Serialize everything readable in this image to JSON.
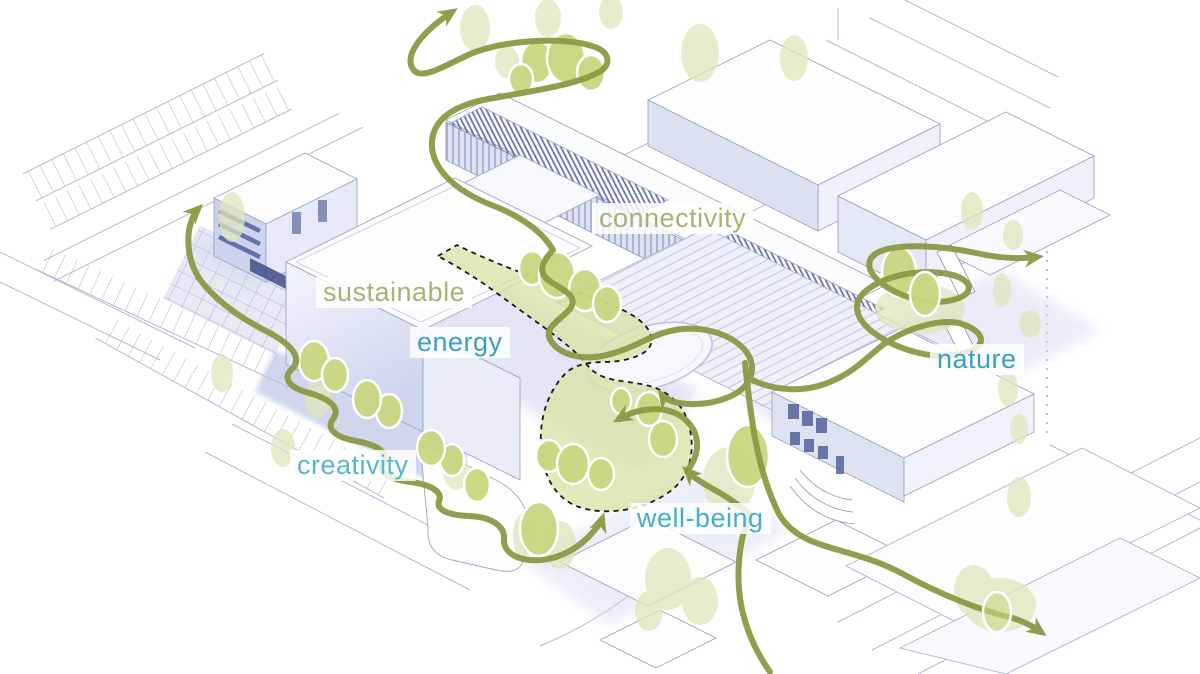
{
  "page": {
    "title": "Campus masterplan concept diagram"
  },
  "diagram": {
    "type": "architectural-concept-axonometric",
    "description": "White axonometric rendering of a school campus crossed by a winding olive-green journey path with arrows, clusters of trees, and a dashed green courtyard zone.",
    "annotations": {
      "connectivity": {
        "text": "connectivity",
        "color": "#a3b474"
      },
      "sustainable": {
        "text": "sustainable",
        "color": "#a3b474"
      },
      "energy": {
        "text": "energy",
        "color": "#3d9fbc"
      },
      "nature": {
        "text": "nature",
        "color": "#3aa0bf"
      },
      "creativity": {
        "text": "creativity",
        "color": "#55b9cb"
      },
      "well_being": {
        "text": "well-being",
        "color": "#46aec5"
      }
    },
    "palette": {
      "journey_path": "#8a9a45",
      "tree_fill": "#c9d67f",
      "tree_outline": "#ffffff",
      "soft_canopy": "#dfe6bb",
      "courtyard_fill": "#d8e1a5",
      "courtyard_outline": "#1a1a1a",
      "architecture_line": "#9aa6c8",
      "facade_shadow": "#ccd4ed",
      "accent_dark": "#54629a",
      "ground_shadow": "#c2cbe8"
    }
  }
}
